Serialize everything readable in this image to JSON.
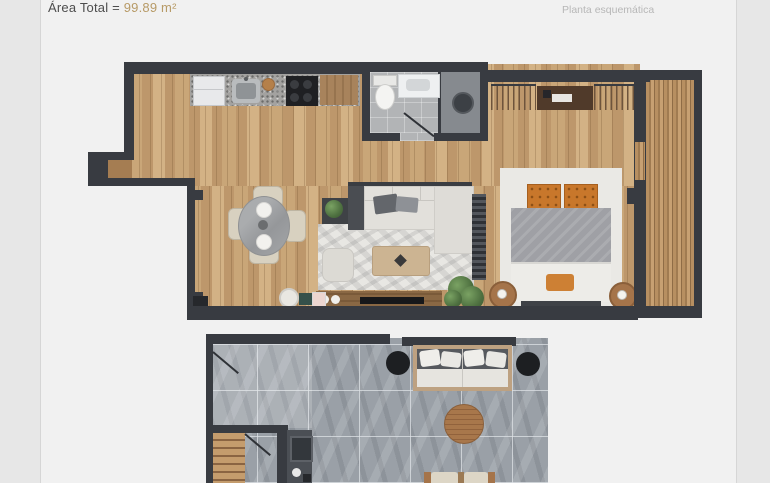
{
  "header": {
    "area_label": "Área Total = ",
    "area_value": "99.89 m²",
    "plan_type_label": "Planta esquemática"
  },
  "colors": {
    "canvas_bg": "#e7e7e7",
    "page_bg": "#f1f1f1",
    "page_border": "#d6d6d6",
    "title": "#4d4d4d",
    "subtitle": "#b7b7b7",
    "gold": "#b79a66",
    "wall": "#383b41",
    "wood_light": "#c9a678",
    "wood_mid": "#bd976b",
    "wood_dark": "#d3b285",
    "terrace_tile": "#9aa0a7",
    "accent_orange": "#c8772b"
  }
}
